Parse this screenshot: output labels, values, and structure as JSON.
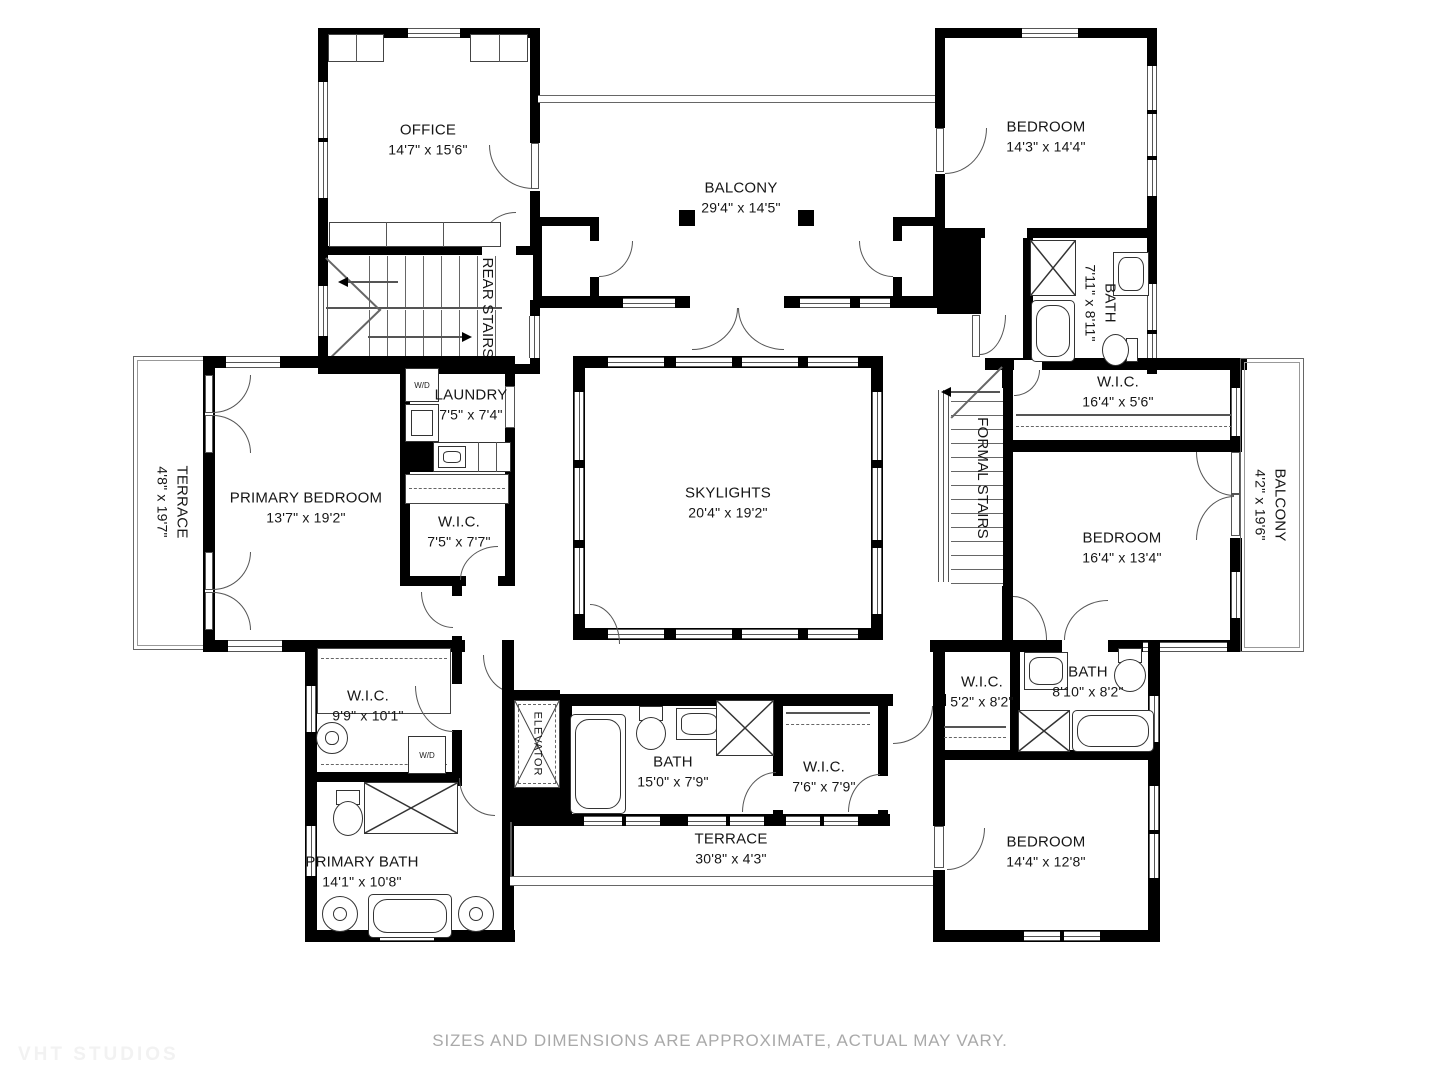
{
  "meta": {
    "footer": "SIZES AND DIMENSIONS ARE APPROXIMATE, ACTUAL MAY VARY.",
    "watermark": "VHT STUDIOS",
    "colors": {
      "wall": "#000000",
      "fixture_line": "#444444",
      "footer_text": "#a9a9a9"
    }
  },
  "appliances": {
    "wd": "W/D"
  },
  "rooms": {
    "office": {
      "name": "OFFICE",
      "dims": "14'7\" x 15'6\""
    },
    "balcony_top": {
      "name": "BALCONY",
      "dims": "29'4\" x 14'5\""
    },
    "bedroom_tr": {
      "name": "BEDROOM",
      "dims": "14'3\" x 14'4\""
    },
    "bath_tr": {
      "name": "BATH",
      "dims": "7'11\" x 8'11\""
    },
    "rear_stairs": {
      "name": "REAR STAIRS"
    },
    "wic_164": {
      "name": "W.I.C.",
      "dims": "16'4\" x 5'6\""
    },
    "terrace_left": {
      "name": "TERRACE",
      "dims": "4'8\" x 19'7\""
    },
    "primary_bedroom": {
      "name": "PRIMARY BEDROOM",
      "dims": "13'7\" x 19'2\""
    },
    "laundry": {
      "name": "LAUNDRY",
      "dims": "7'5\" x 7'4\""
    },
    "wic_75": {
      "name": "W.I.C.",
      "dims": "7'5\" x 7'7\""
    },
    "skylights": {
      "name": "SKYLIGHTS",
      "dims": "20'4\" x 19'2\""
    },
    "formal_stairs": {
      "name": "FORMAL STAIRS"
    },
    "bedroom_mr": {
      "name": "BEDROOM",
      "dims": "16'4\" x 13'4\""
    },
    "balcony_right": {
      "name": "BALCONY",
      "dims": "4'2\" x 19'6\""
    },
    "wic_99": {
      "name": "W.I.C.",
      "dims": "9'9\" x 10'1\""
    },
    "primary_bath": {
      "name": "PRIMARY BATH",
      "dims": "14'1\" x 10'8\""
    },
    "elevator": {
      "name": "ELEVATOR"
    },
    "bath_150": {
      "name": "BATH",
      "dims": "15'0\" x 7'9\""
    },
    "wic_76": {
      "name": "W.I.C.",
      "dims": "7'6\" x 7'9\""
    },
    "terrace_bottom": {
      "name": "TERRACE",
      "dims": "30'8\" x 4'3\""
    },
    "wic_52": {
      "name": "W.I.C.",
      "dims": "5'2\" x 8'2\""
    },
    "bath_810": {
      "name": "BATH",
      "dims": "8'10\" x 8'2\""
    },
    "bedroom_br": {
      "name": "BEDROOM",
      "dims": "14'4\" x 12'8\""
    }
  }
}
